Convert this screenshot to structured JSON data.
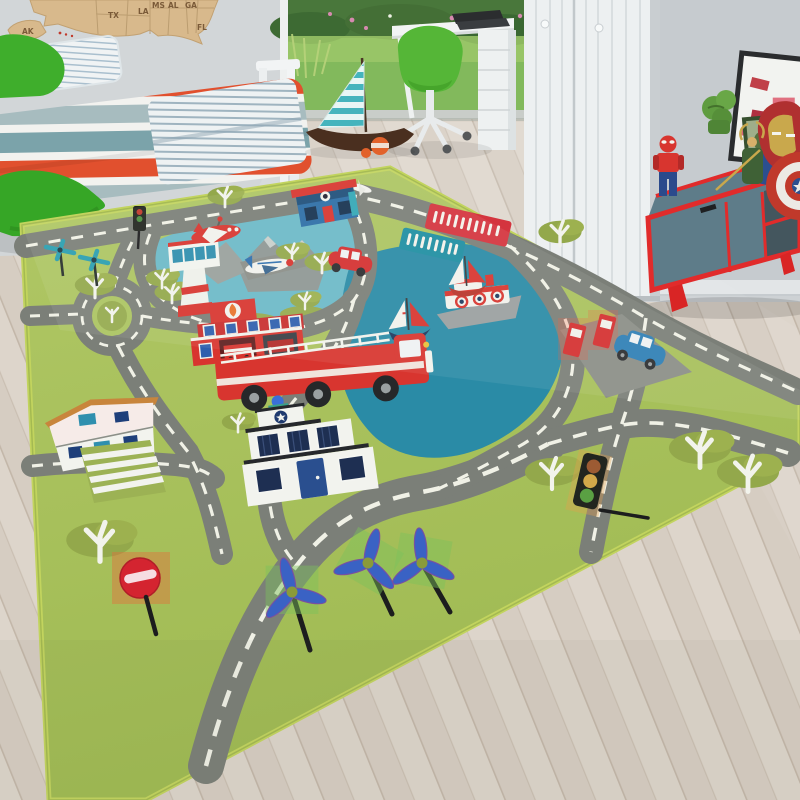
{
  "scene": {
    "title": "Children's room with city-road play rug",
    "setting": "kids bedroom, product photo",
    "wall_color": "#d1d5d7",
    "floor": "whitewashed wood planks"
  },
  "wall_map": {
    "material": "wooden USA puzzle map",
    "labels": [
      "AK",
      "TX",
      "LA",
      "MS",
      "AL",
      "GA",
      "FL"
    ]
  },
  "bed": {
    "duvet_stripe_colors": [
      "#e1502e",
      "#f2f2ef",
      "#7ba3aa",
      "#a7bcbf"
    ],
    "pillow": "white with blue pinstripes",
    "cushions": [
      "green leaf cushion on bed",
      "green leaf cushion on floor"
    ]
  },
  "garden": {
    "visible_through": "open patio door",
    "elements": [
      "lawn",
      "dark bushes",
      "pink flowers",
      "tall grasses"
    ]
  },
  "desk_area": {
    "chair_color": "#55b637",
    "desk_color": "#f2f4f4",
    "items": [
      "black laptop",
      "white drawer unit"
    ]
  },
  "wardrobe": {
    "color": "#edf0f1",
    "doors": 2,
    "knobs": 2
  },
  "sideboard": {
    "frame_color": "#e12b2b",
    "door_color": "#5e7c89",
    "toys_on_top": [
      "lego-spiderman",
      "loki-figure",
      "iron-man-helmet",
      "captain-america-shield",
      "hulk-fist",
      "framed-poster",
      "green-frame",
      "blue-box"
    ]
  },
  "floor_toys": [
    "wooden sailboat with teal striped sail",
    "orange buoy"
  ],
  "rug": {
    "theme": "city roads kids play rug",
    "grass_color": "#a6be5b",
    "border_color": "#c2d45e",
    "road_color": "#7b7f78",
    "road_marking_color": "#f0f1e6",
    "lake_color": "#2a8ba6",
    "airport_water_color": "#6cbac8",
    "banners": [
      {
        "color": "#d4343e",
        "text_legible": false
      },
      {
        "color": "#1f8fa2",
        "text_legible": false
      }
    ],
    "buildings": [
      "fire-station",
      "police-station",
      "house",
      "corner-shop",
      "airport-control-tower",
      "gas-station"
    ],
    "vehicles": [
      "fire-truck",
      "red-car",
      "blue-car",
      "red-airplane",
      "propeller-airplane",
      "small-white-airplane",
      "ferry",
      "sailboat",
      "sailboat"
    ],
    "signs": [
      "no-entry-sign",
      "traffic-light",
      "traffic-light"
    ],
    "nature": {
      "trees": "olive canopies with white trunks",
      "wind_turbines_large": 3,
      "wind_turbines_small": 2,
      "roundabouts": 1
    }
  }
}
